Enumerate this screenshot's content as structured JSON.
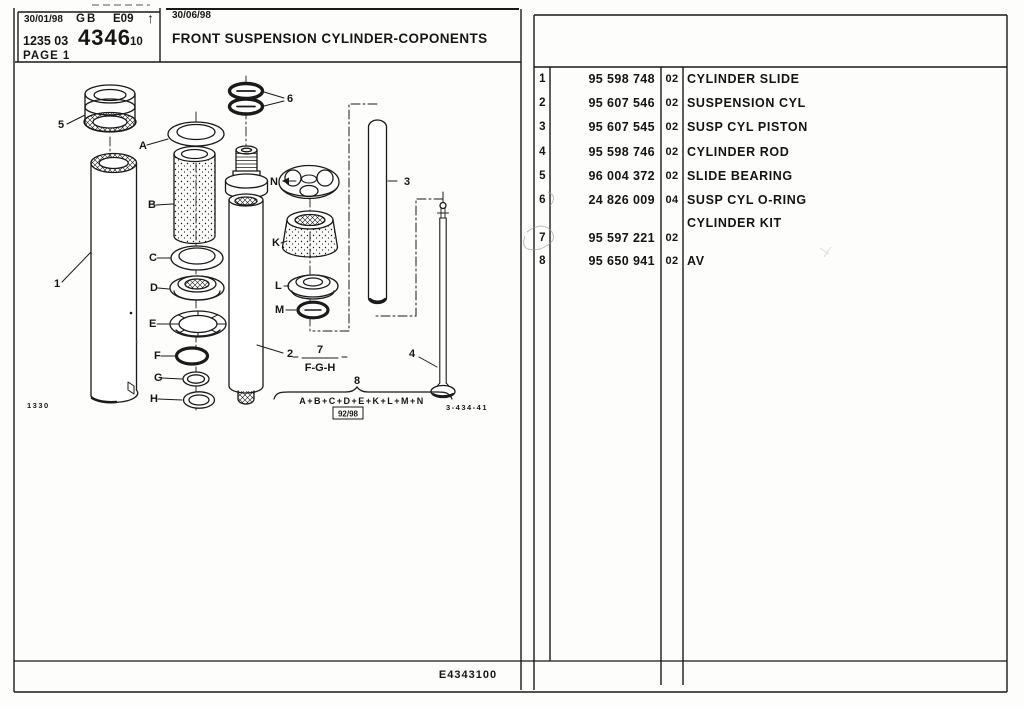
{
  "header": {
    "date_left": "30/01/98",
    "country": "GB",
    "code": "E09",
    "arrow": "↑",
    "catalog_no": "1235 03",
    "group_no": "4346",
    "variant": "10",
    "page": "PAGE 1",
    "date_revision": "30/06/98",
    "title": "FRONT SUSPENSION CYLINDER-COPONENTS"
  },
  "parts_table": {
    "rows": [
      {
        "ref": "1",
        "part_number": "95 598 748",
        "qty": "02",
        "description": "CYLINDER SLIDE"
      },
      {
        "ref": "2",
        "part_number": "95 607 546",
        "qty": "02",
        "description": "SUSPENSION CYL"
      },
      {
        "ref": "3",
        "part_number": "95 607 545",
        "qty": "02",
        "description": "SUSP CYL PISTON"
      },
      {
        "ref": "4",
        "part_number": "95 598 746",
        "qty": "02",
        "description": "CYLINDER ROD"
      },
      {
        "ref": "5",
        "part_number": "96 004 372",
        "qty": "02",
        "description": "SLIDE BEARING"
      },
      {
        "ref": "6",
        "part_number": "24 826 009",
        "qty": "04",
        "description": "SUSP CYL O-RING"
      },
      {
        "ref": "",
        "part_number": "",
        "qty": "",
        "description": "CYLINDER KIT"
      },
      {
        "ref": "7",
        "part_number": "95 597 221",
        "qty": "02",
        "description": ""
      },
      {
        "ref": "8",
        "part_number": "95 650 941",
        "qty": "02",
        "description": "AV"
      }
    ]
  },
  "diagram": {
    "callouts": {
      "p1": "1",
      "p2": "2",
      "p3": "3",
      "p4": "4",
      "p5": "5",
      "p6": "6",
      "pA": "A",
      "pB": "B",
      "pC": "C",
      "pD": "D",
      "pE": "E",
      "pF": "F",
      "pG": "G",
      "pH": "H",
      "pK": "K",
      "pL": "L",
      "pM": "M",
      "pN": "N"
    },
    "kit7": {
      "ref": "7",
      "items": "F-G-H"
    },
    "kit8": {
      "ref": "8",
      "items": "A+B+C+D+E+K+L+M+N",
      "date_box": "92/98"
    },
    "plate_no": "1330",
    "drawing_no": "3-434-41"
  },
  "footer": {
    "code": "E4343100"
  }
}
